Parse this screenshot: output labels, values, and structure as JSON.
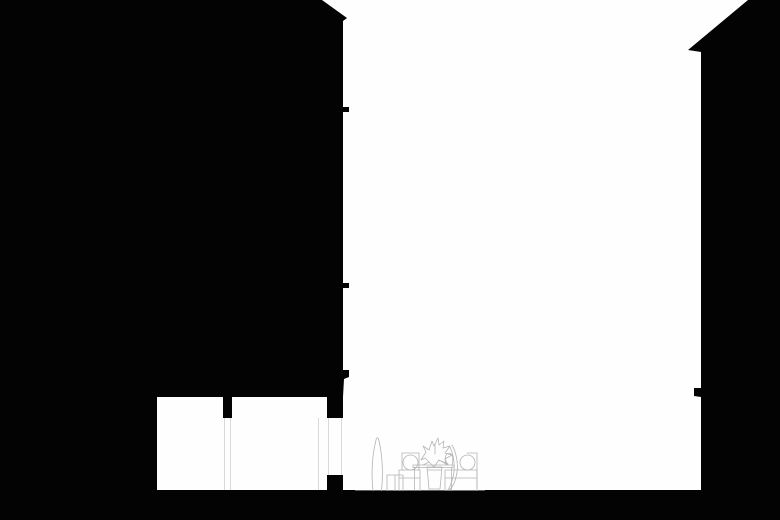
{
  "meta": {
    "type": "architectural-section-drawing",
    "description": "Black silhouette cross-section of two buildings flanking a white courtyard with a light-gray line drawing of outdoor furniture at grade",
    "text_content": "none"
  },
  "colors": {
    "background": "#fefefe",
    "ink": "#030303",
    "furniture_line": "#b4b4b4",
    "detail_line": "#d9d9d9"
  },
  "scene": {
    "left_building": {
      "label": "left building mass in section",
      "roof_slope": "rises toward right edge, small eave overhang",
      "slab_notches_y": [
        107,
        283,
        370
      ],
      "wall_x": 343
    },
    "basement": {
      "label": "two white basement rooms carved from left mass",
      "rooms": [
        {
          "x": 157,
          "y": 397,
          "w": 66,
          "h": 93
        },
        {
          "x": 232,
          "y": 397,
          "w": 95,
          "h": 93
        }
      ],
      "pier_window_gap_y": [
        418,
        475
      ]
    },
    "right_building": {
      "label": "right building mass in section",
      "roof_slope": "descends left from top, eave tip at (688,50)",
      "balcony_notch_y": 388,
      "wall_x": 701
    },
    "ground": {
      "label": "ground plane",
      "top_y": 490
    },
    "furniture": {
      "label": "courtyard furniture line drawing",
      "items": [
        "tall-vase",
        "stool",
        "left-armchair",
        "potted-plant",
        "table",
        "small-vase",
        "draped-leaf",
        "right-armchair"
      ]
    }
  }
}
